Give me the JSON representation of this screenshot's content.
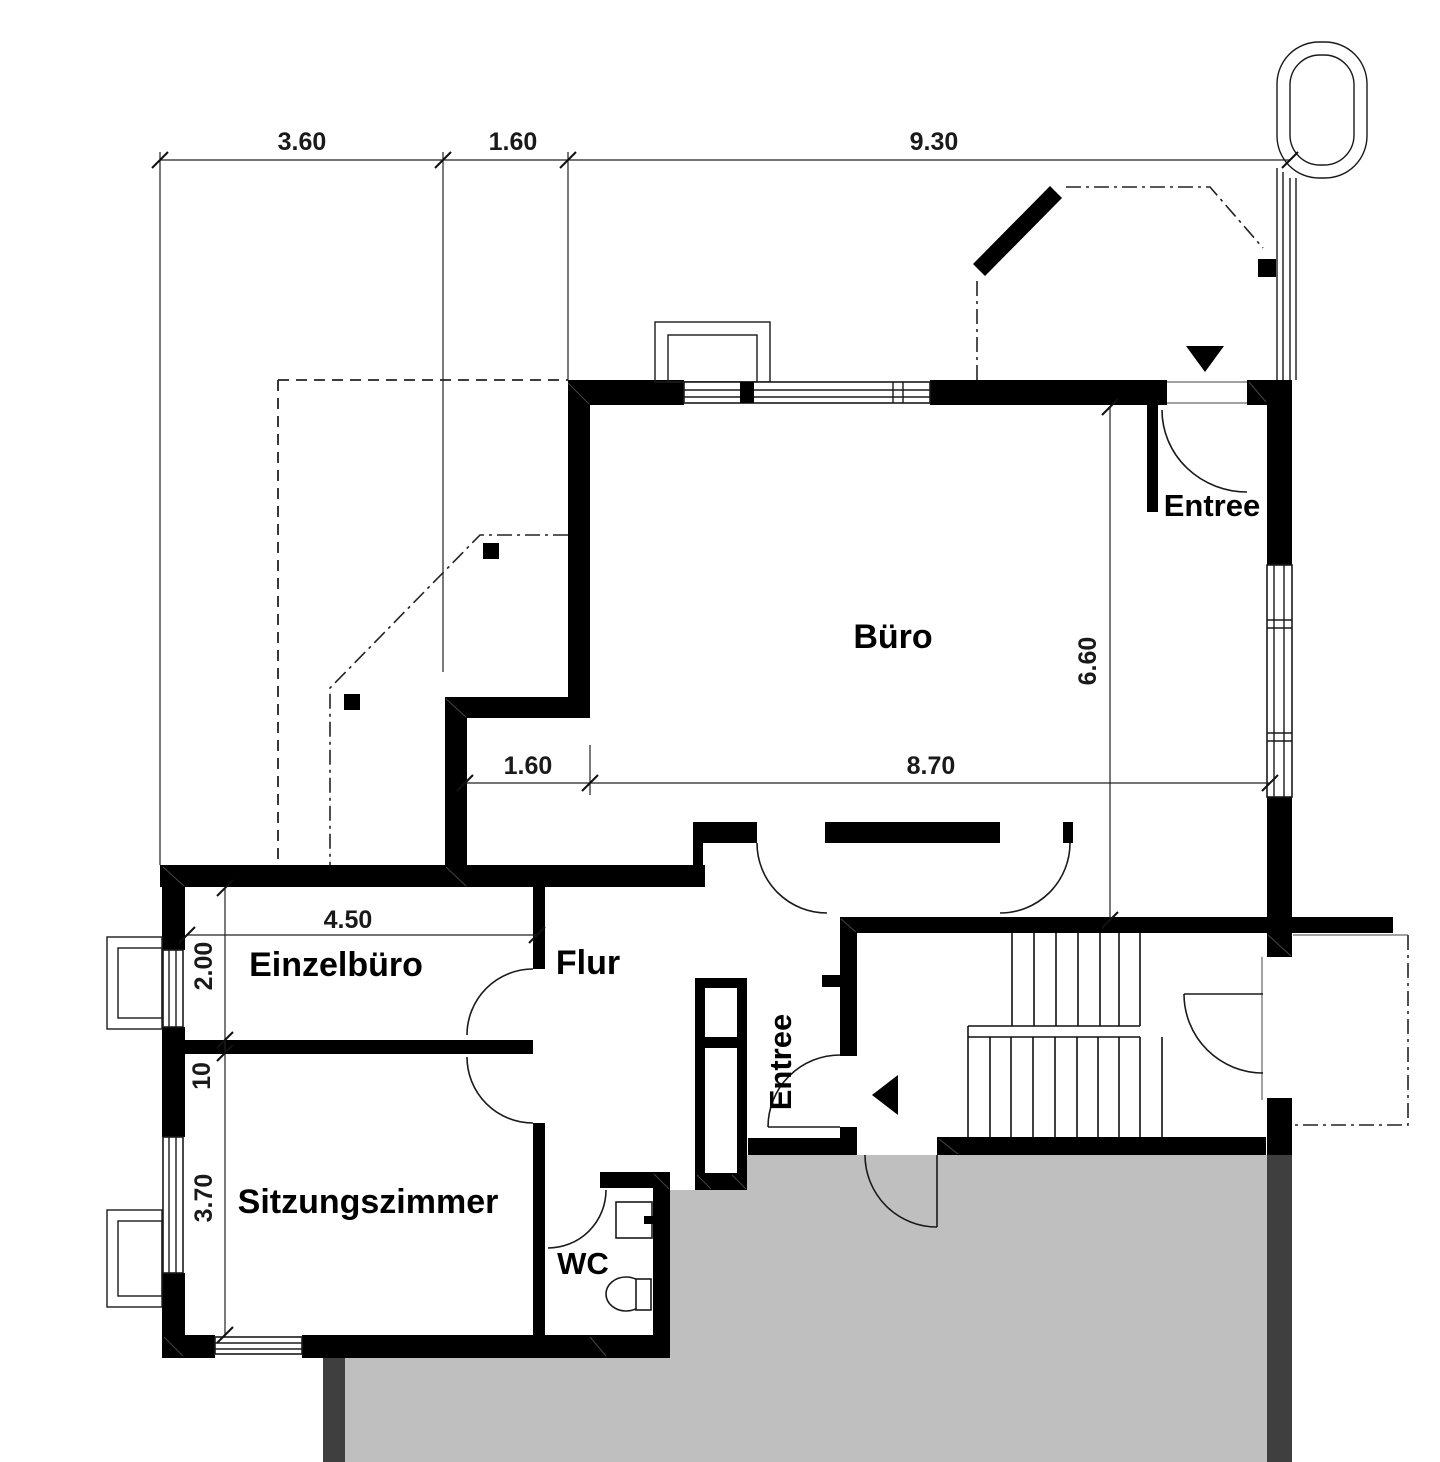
{
  "title": "Grundriss Erdgeschoss",
  "rooms": {
    "buero": "Büro",
    "entree_top": "Entree",
    "entree_bottom": "Entree",
    "einzelbuero": "Einzelbüro",
    "flur": "Flur",
    "sitzungszimmer": "Sitzungszimmer",
    "wc": "WC"
  },
  "dimensions": {
    "top_left": "3.60",
    "top_mid": "1.60",
    "top_right": "9.30",
    "inner_left": "1.60",
    "inner_right": "8.70",
    "einzelbuero_width": "4.50",
    "einzelbuero_height": "2.00",
    "wall_thickness": "10",
    "sitzungszimmer_height": "3.70",
    "buero_height": "6.60"
  },
  "colors": {
    "wall": "#000000",
    "floor_slab": "#bfbfbf",
    "slab_edge": "#3f3f3f",
    "background": "#ffffff"
  },
  "icons": {
    "entrance_arrow_top": "triangle-down",
    "entrance_arrow_bottom": "triangle-left"
  }
}
